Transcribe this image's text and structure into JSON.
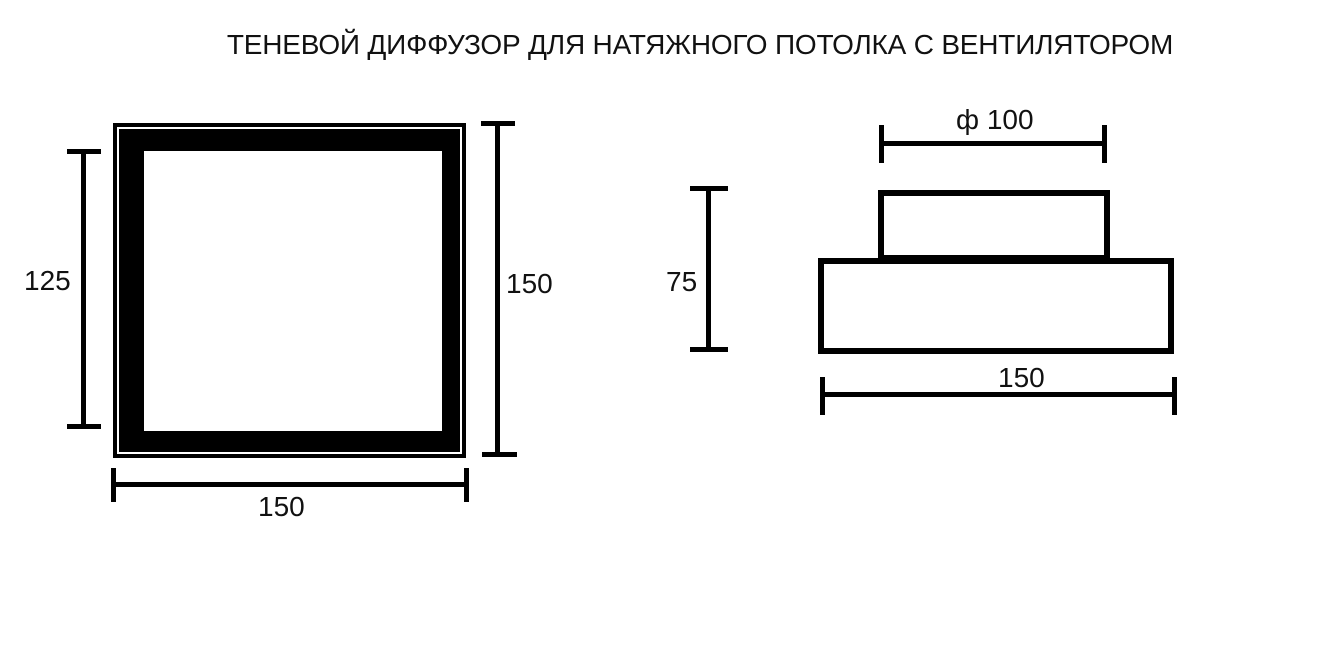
{
  "title": "ТЕНЕВОЙ ДИФФУЗОР ДЛЯ НАТЯЖНОГО ПОТОЛКА С ВЕНТИЛЯТОРОМ",
  "colors": {
    "line": "#000000",
    "text": "#111111",
    "background": "#ffffff"
  },
  "front_view": {
    "dim_inner_height": "125",
    "dim_outer_height": "150",
    "dim_outer_width": "150"
  },
  "side_view": {
    "dim_diameter": "ф 100",
    "dim_height": "75",
    "dim_width": "150"
  }
}
